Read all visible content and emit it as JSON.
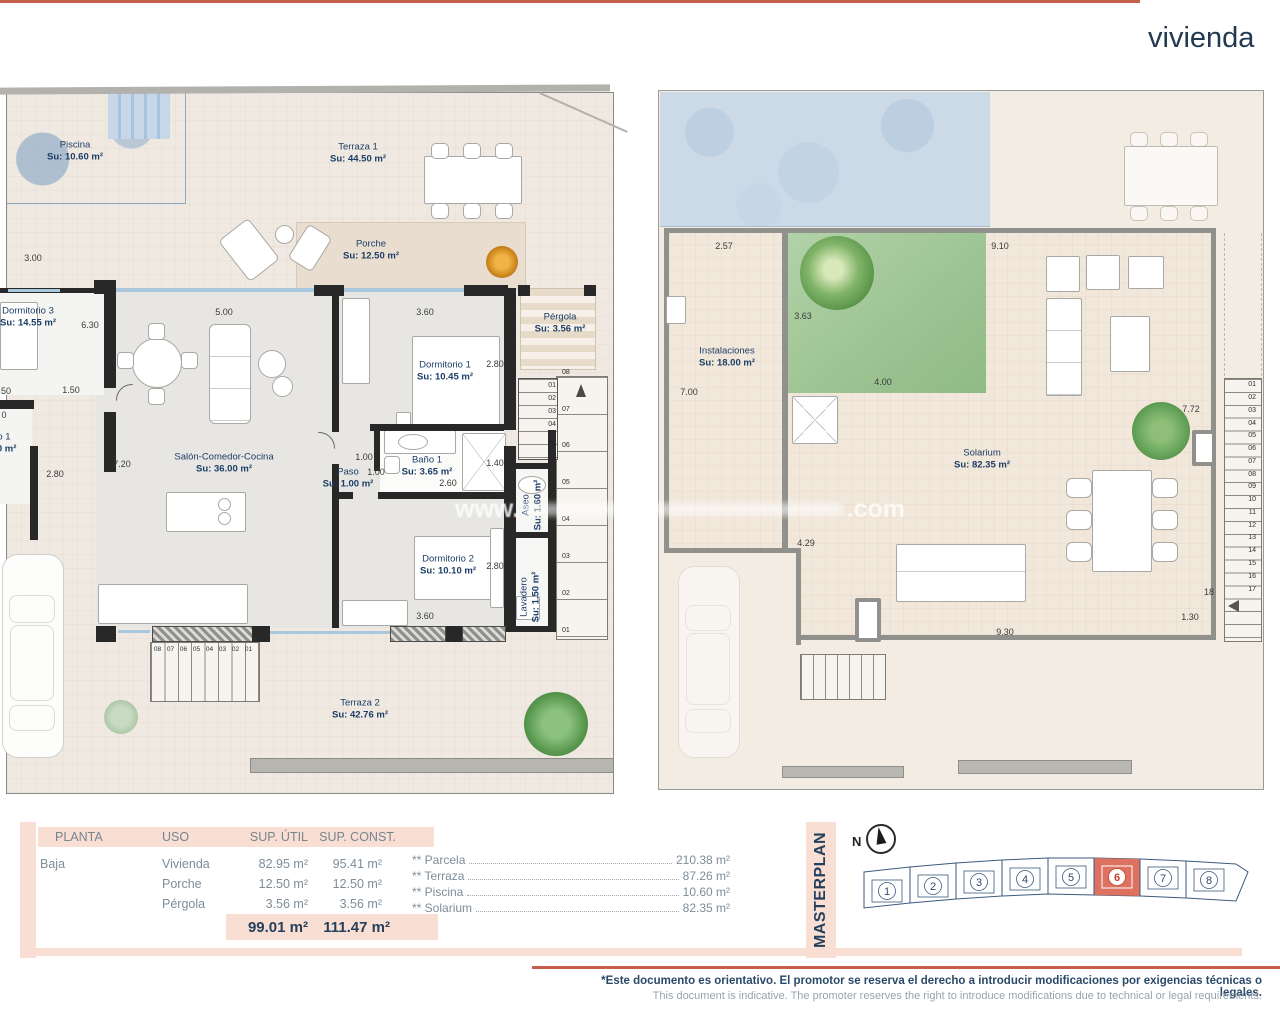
{
  "header": {
    "title": "vivienda"
  },
  "watermark": {
    "prefix": "www.",
    "suffix": ".com"
  },
  "plan_left": {
    "rooms": {
      "piscina": {
        "name": "Piscina",
        "su": "Su: 10.60 m²"
      },
      "terraza1": {
        "name": "Terraza 1",
        "su": "Su: 44.50 m²"
      },
      "porche": {
        "name": "Porche",
        "su": "Su: 12.50 m²"
      },
      "pergola": {
        "name": "Pérgola",
        "su": "Su: 3.56 m²"
      },
      "dormitorio3": {
        "name": "Dormitorio 3",
        "su": "Su: 14.55 m²"
      },
      "dormitorio1": {
        "name": "Dormitorio 1",
        "su": "Su: 10.45 m²"
      },
      "salon": {
        "name": "Salón-Comedor-Cocina",
        "su": "Su: 36.00 m²"
      },
      "paso": {
        "name": "Paso",
        "su": "Su: 1.00 m²"
      },
      "bano1": {
        "name": "Baño 1",
        "su": "Su: 3.65 m²"
      },
      "dormitorio2": {
        "name": "Dormitorio 2",
        "su": "Su: 10.10 m²"
      },
      "aseo": {
        "name": "Aseo",
        "su": "Su: 1.60 m²"
      },
      "lavadero": {
        "name": "Lavadero",
        "su": "Su: 1.50 m²"
      },
      "terraza2": {
        "name": "Terraza 2",
        "su": "Su: 42.76 m²"
      },
      "partial": {
        "name": "o 1",
        "su": "00 m²"
      }
    },
    "dims": {
      "d300": "3.00",
      "d630": "6.30",
      "d500": "5.00",
      "d360a": "3.60",
      "d280a": "2.80",
      "d150": "1.50",
      "d720": "7.20",
      "d100a": "1.00",
      "d100b": "1.00",
      "d260": "2.60",
      "d140": "1.40",
      "d280b": "2.80",
      "d360b": "3.60",
      "d280c": "2.80",
      "p50": "50",
      "p0": "0"
    },
    "stairs_bottom": [
      "08",
      "07",
      "06",
      "05",
      "04",
      "03",
      "02",
      "01"
    ],
    "stairs_side": [
      "08",
      "07",
      "06",
      "05",
      "04",
      "03",
      "02",
      "01"
    ],
    "stairs_inner": [
      "01",
      "02",
      "03",
      "04",
      "05",
      "06"
    ]
  },
  "plan_right": {
    "rooms": {
      "instalaciones": {
        "name": "Instalaciones",
        "su": "Su: 18.00 m²"
      },
      "solarium": {
        "name": "Solarium",
        "su": "Su: 82.35 m²"
      }
    },
    "dims": {
      "d257": "2.57",
      "d910": "9.10",
      "d363": "3.63",
      "d700": "7.00",
      "d400": "4.00",
      "d772": "7.72",
      "d429": "4.29",
      "d930": "9.30",
      "d130": "1.30",
      "d18": "18"
    },
    "stairs": [
      "01",
      "02",
      "03",
      "04",
      "05",
      "06",
      "07",
      "08",
      "09",
      "10",
      "11",
      "12",
      "13",
      "14",
      "15",
      "16",
      "17"
    ]
  },
  "table": {
    "headers": {
      "planta": "PLANTA",
      "uso": "USO",
      "util": "SUP. ÚTIL",
      "const": "SUP. CONST."
    },
    "planta": "Baja",
    "rows": [
      {
        "uso": "Vivienda",
        "util": "82.95 m²",
        "const": "95.41 m²"
      },
      {
        "uso": "Porche",
        "util": "12.50 m²",
        "const": "12.50 m²"
      },
      {
        "uso": "Pérgola",
        "util": "3.56 m²",
        "const": "3.56 m²"
      }
    ],
    "total_util": "99.01 m²",
    "total_const": "111.47 m²"
  },
  "summary": [
    {
      "label": "** Parcela",
      "value": "210.38 m²"
    },
    {
      "label": "** Terraza",
      "value": "87.26 m²"
    },
    {
      "label": "** Piscina",
      "value": "10.60 m²"
    },
    {
      "label": "** Solarium",
      "value": "82.35 m²"
    }
  ],
  "masterplan": {
    "title": "MASTERPLAN",
    "north": "N",
    "plots": [
      "1",
      "2",
      "3",
      "4",
      "5",
      "6",
      "7",
      "8"
    ],
    "highlighted_plot": "6"
  },
  "footer": {
    "line1": "*Este documento es orientativo. El promotor se reserva el derecho a introducir modificaciones por exigencias técnicas o legales.",
    "line2": "This document is indicative. The promoter reserves the right to introduce modifications due to technical or legal requirements."
  },
  "colors": {
    "accent": "#c75f4d",
    "navy": "#24405c",
    "highlight": "#dd7260",
    "pink": "#f9ded3"
  }
}
